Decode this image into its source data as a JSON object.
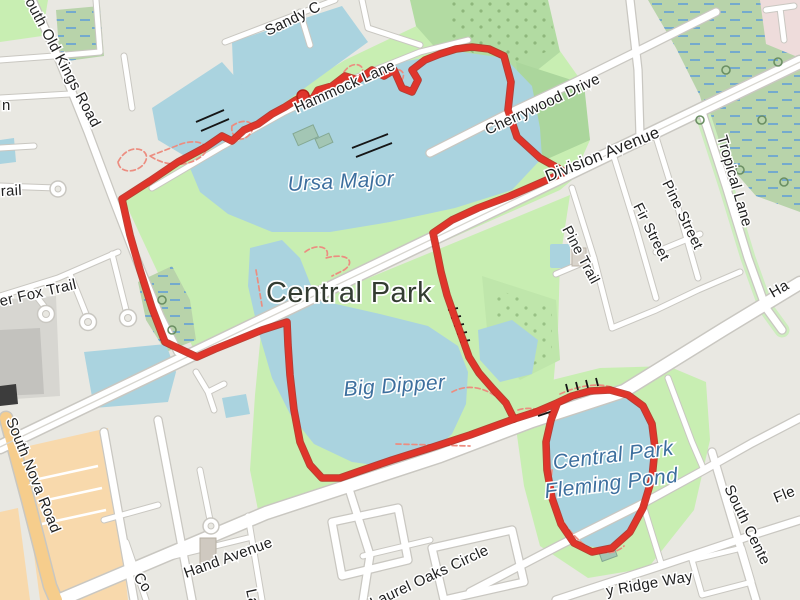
{
  "map": {
    "kind": "street map with GPS route overlay",
    "park_label": "Central Park",
    "water_labels": {
      "ursa_major": "Ursa Major",
      "big_dipper": "Big Dipper",
      "fleming_line1": "Central Park",
      "fleming_line2": "Fleming Pond"
    },
    "street_labels": {
      "south_old_kings_road": "South Old Kings Road",
      "sandy": "Sandy C",
      "hammock_lane": "Hammock Lane",
      "cherrywood_drive": "Cherrywood Drive",
      "division_avenue": "Division Avenue",
      "tropical_lane": "Tropical Lane",
      "pine_street": "Pine Street",
      "fir_street": "Fir Street",
      "pine_trail": "Pine Trail",
      "silver_fox_trail": "Silver Fox Trail",
      "south_nova_road": "South Nova Road",
      "hand_avenue": "Hand Avenue",
      "laurel_oaks_circle": "Laurel Oaks Circle",
      "ridge_way": "y Ridge Way",
      "south_center": "South Cente",
      "fleming_partial": "Fle",
      "hand_partial": "Ha",
      "co_partial": "Co",
      "la_partial": "La",
      "n_partial": "n",
      "trail_partial": "rail"
    },
    "route": {
      "color": "#e0352b",
      "marker": "start-dot"
    },
    "colors": {
      "water": "#aad3df",
      "park": "#c8eeb2",
      "wood": "#abd69c",
      "wetland": "#b8d3aa",
      "residential": "#e9e8e2",
      "road_fill": "#ffffff",
      "road_casing": "#c9c7c1",
      "primary_road": "#f6cd8c",
      "retail": "#f8d9ac",
      "commercial_pink": "#eedcdb",
      "route_red": "#e0352b",
      "water_label_blue": "#3d6f9e"
    }
  }
}
